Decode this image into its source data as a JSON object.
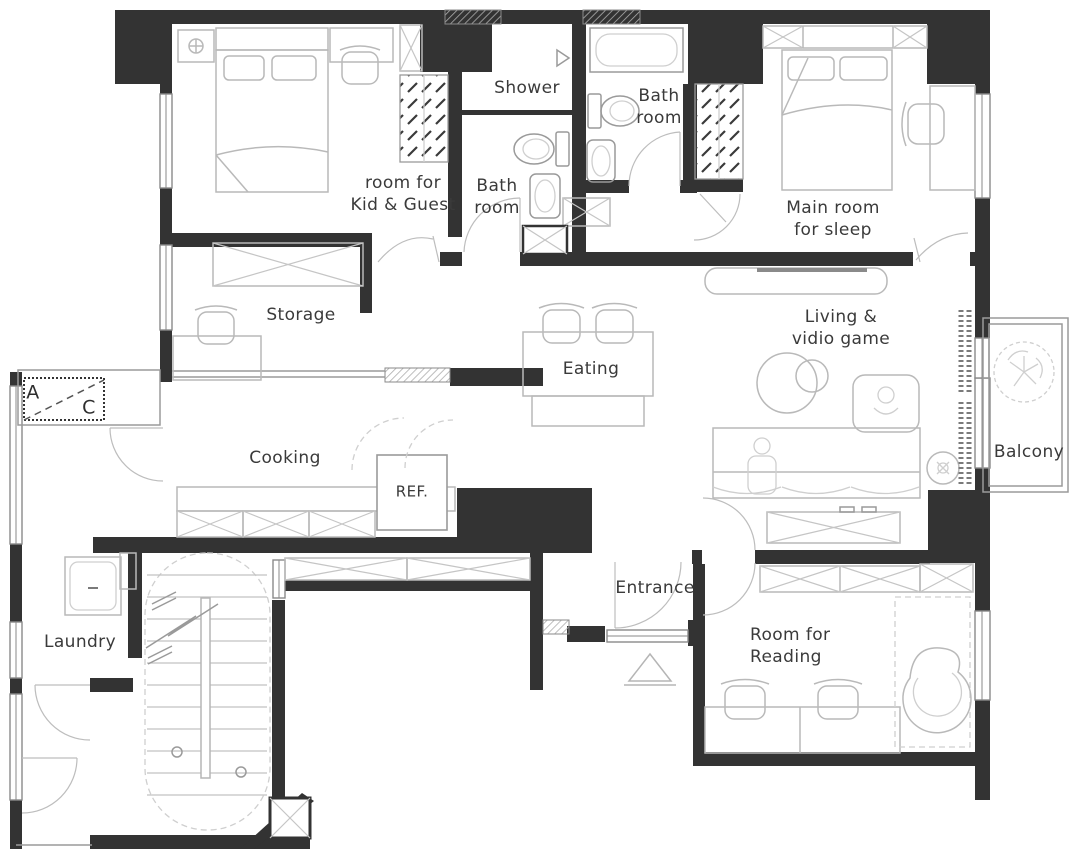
{
  "title": "Apartment floor plan",
  "palette": {
    "wall": "#333333",
    "furniture_line": "#b9b9b9",
    "window_line": "#8a8a8a",
    "text": "#3a3a3a",
    "background": "#ffffff"
  },
  "rooms": [
    {
      "id": "kid_guest",
      "label": "room for\nKid & Guest"
    },
    {
      "id": "shower",
      "label": "Shower"
    },
    {
      "id": "bath_inner",
      "label": "Bath\nroom"
    },
    {
      "id": "bath_main",
      "label": "Bath\nroom"
    },
    {
      "id": "main_bedroom",
      "label": "Main room\nfor sleep"
    },
    {
      "id": "storage",
      "label": "Storage"
    },
    {
      "id": "eating",
      "label": "Eating"
    },
    {
      "id": "living",
      "label": "Living &\nvidio game"
    },
    {
      "id": "balcony",
      "label": "Balcony"
    },
    {
      "id": "cooking",
      "label": "Cooking"
    },
    {
      "id": "laundry",
      "label": "Laundry"
    },
    {
      "id": "entrance",
      "label": "Entrance"
    },
    {
      "id": "reading",
      "label": "Room for\nReading"
    }
  ],
  "appliances": {
    "refrigerator_label": "REF."
  },
  "section_marker": {
    "start": "A",
    "end": "C"
  },
  "furniture_icons": [
    "double-bed-icon",
    "pillow-icon",
    "nightstand-lamp-icon",
    "wardrobe-icon",
    "closet-x-cabinet-icon",
    "desk-icon",
    "chair-icon",
    "toilet-icon",
    "sink-icon",
    "bathtub-icon",
    "shower-door-icon",
    "dining-table-icon",
    "bench-icon",
    "tv-console-icon",
    "sofa-icon",
    "gaming-chair-icon",
    "side-table-icon",
    "floor-lamp-icon",
    "media-cabinet-icon",
    "kitchen-counter-icon",
    "refrigerator-icon",
    "washing-machine-icon",
    "stairs-icon",
    "lounge-chair-icon",
    "plant-icon",
    "curtain-icon",
    "entry-arrow-icon",
    "door-swing-icon",
    "window-icon",
    "entry-step-icon"
  ]
}
